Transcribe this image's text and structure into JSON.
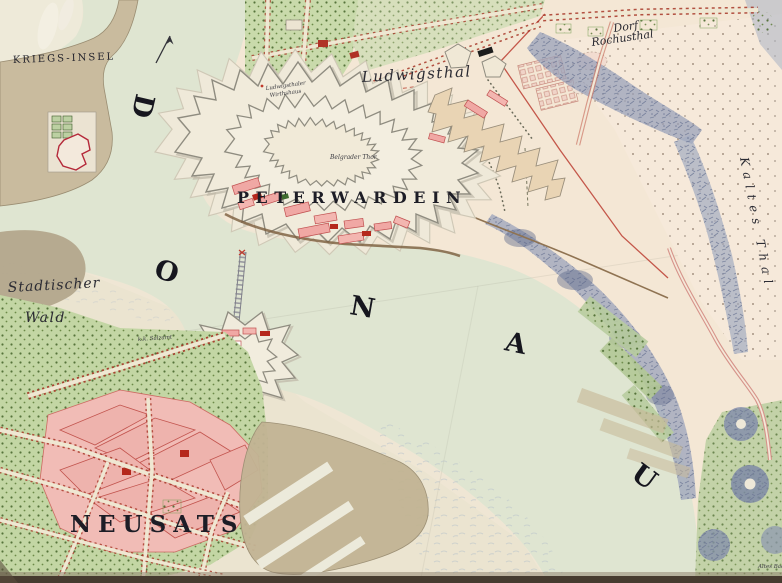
{
  "map": {
    "type": "historical-fortification-plan",
    "river_letters": [
      "D",
      "O",
      "N",
      "A",
      "U"
    ],
    "labels": {
      "kriegs_insel": "KRIEGS-INSEL",
      "peterwardein": "PETERWARDEIN",
      "neusats": "NEUSATS",
      "ludwigsthal": "Ludwigsthal",
      "dorf_line1": "Dorf",
      "dorf_line2": "Rochusthal",
      "kaltes_thal": "Kaltes Thal",
      "stadtischer_line1": "Stadtischer",
      "stadtischer_line2": "Wald",
      "belgrader_thor": "Belgrader Thor",
      "wirthshaus_line1": "Ludwigsthaler",
      "wirthshaus_line2": "Wirthshaus",
      "salzamt": "k.k. Salzamt",
      "altes_bad": "Altes Bad"
    },
    "icons": {
      "north_arrow": "north-arrow"
    },
    "colors": {
      "paper": "#ece4d1",
      "paper_warm": "#f4e7d5",
      "water": "#dfe5d1",
      "island_sand": "#c9bb9e",
      "forest_brown": "#b3a78c",
      "town_pink": "#f1bcb6",
      "building_red": "#a8291f",
      "garden_green": "#c3d6a4",
      "hill_blue": "#99a2ba",
      "wall_gray": "#8f8c80",
      "road_red": "#c4574a",
      "ink": "#1d1d26",
      "sandbank": "#c2b494"
    }
  }
}
